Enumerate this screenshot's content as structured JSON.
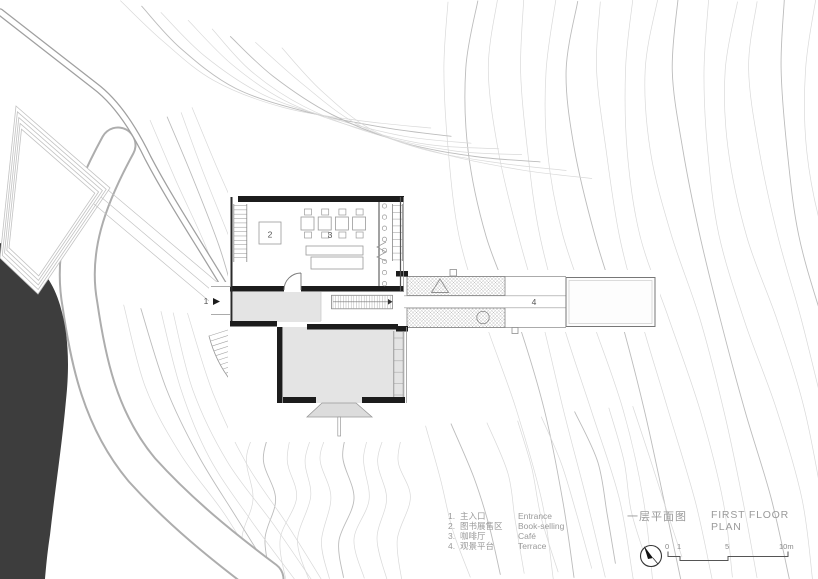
{
  "title": {
    "zh": "一层平面图",
    "en": "FIRST FLOOR PLAN"
  },
  "legend": {
    "items": [
      {
        "num": "1.",
        "zh": "主入口",
        "en": "Entrance"
      },
      {
        "num": "2.",
        "zh": "图书展售区",
        "en": "Book-selling"
      },
      {
        "num": "3.",
        "zh": "咖啡厅",
        "en": "Café"
      },
      {
        "num": "4.",
        "zh": "观景平台",
        "en": "Terrace"
      }
    ]
  },
  "plan_labels": {
    "entrance": "1",
    "book_area": "2",
    "cafe": "3",
    "terrace": "4"
  },
  "scalebar": {
    "ticks": [
      "0",
      "1",
      "5",
      "10m"
    ]
  },
  "colors": {
    "contour": "#d9d9d9",
    "contour_dark": "#bcbcbc",
    "wall": "#1c1c1c",
    "room_fill": "#e4e4e4",
    "steps_fill": "#dcdcdc",
    "pond": "#3d3d3d",
    "line": "#8f8f8f",
    "line_light": "#ababab",
    "label": "#9a9a9a",
    "ink": "#333333"
  }
}
